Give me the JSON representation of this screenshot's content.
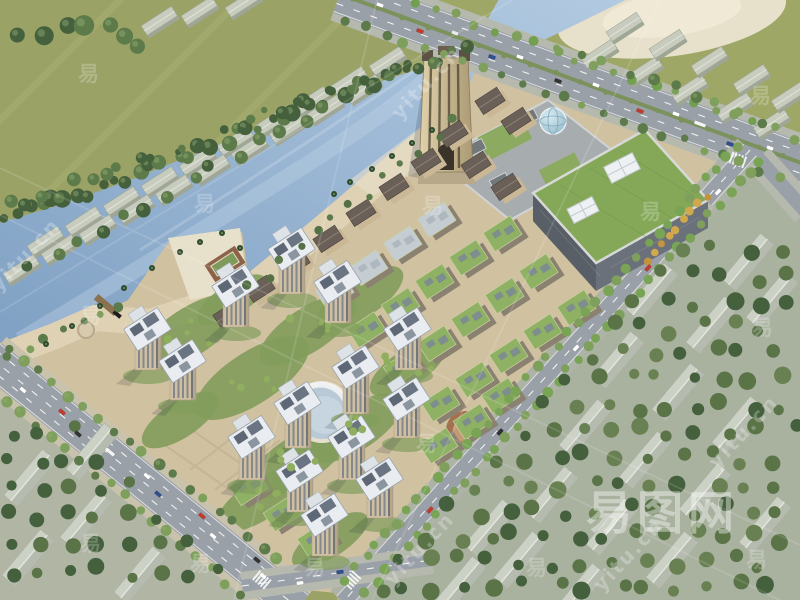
{
  "watermark": {
    "logo_text": "易图网",
    "url_text": "yitu.cn",
    "glyph_text": "易",
    "logo": {
      "x": 586,
      "y": 477,
      "size": 46,
      "letter_spacing": 5,
      "opacity": 0.4
    },
    "url_tiles": [
      {
        "x": 597,
        "y": 576
      },
      {
        "x": 388,
        "y": 570
      },
      {
        "x": 712,
        "y": 453
      },
      {
        "x": 395,
        "y": 104
      },
      {
        "x": -6,
        "y": 276
      }
    ],
    "url_size": 20,
    "url_opacity": 0.26,
    "glyphs": [
      {
        "x": 78,
        "y": 58
      },
      {
        "x": 194,
        "y": 188
      },
      {
        "x": 422,
        "y": 190
      },
      {
        "x": 640,
        "y": 196
      },
      {
        "x": 750,
        "y": 80
      },
      {
        "x": 752,
        "y": 312
      },
      {
        "x": 80,
        "y": 300
      },
      {
        "x": 416,
        "y": 428
      },
      {
        "x": 80,
        "y": 528
      },
      {
        "x": 190,
        "y": 548
      },
      {
        "x": 304,
        "y": 552
      },
      {
        "x": 526,
        "y": 552
      },
      {
        "x": 746,
        "y": 544
      }
    ],
    "glyph_size": 21,
    "glyph_opacity": 0.22
  },
  "palette": {
    "field": "#9aa266",
    "field2": "#9ea765",
    "mow": "#a9b074",
    "water1": "#7fa0c3",
    "water2": "#b3cbe2",
    "water_hl": "#c3d6e8",
    "sand": "#e7e0cb",
    "sand2": "#ddd0ae",
    "paving": "#d0c1a1",
    "paving_light": "#dfd2b4",
    "road": "#9aa0a8",
    "road_side": "#b6b9ae",
    "lane": "#ffffff",
    "median": "#7c925c",
    "tree_dark": "#44603c",
    "tree_mid": "#5d7a4a",
    "tree_light": "#7fa05c",
    "tree_pale": "#93ac74",
    "tree_yellow": "#d2a84e",
    "warehouse_roof": "#c7ccbe",
    "warehouse_side": "#9fa696",
    "house_roof": "#ccd1c5",
    "house_side": "#b2b9ac",
    "housing_ground": "#a9b19f",
    "mall_roof": "#84a858",
    "mall_wall_sw": "#585f66",
    "mall_wall_se": "#6a717a",
    "mall_trim": "#d6d9d6",
    "skylight": "#eef1f3",
    "podium": "#a7adaf",
    "courtyard": "#8cab60",
    "pavilion": "#73797b",
    "tower_hi": "#e0d2ac",
    "tower_lo": "#ab9a74",
    "tower_dark": "#544a38",
    "res_wall": "#cfc0a2",
    "res_win": "#6b7585",
    "roof_white": "#e9edf1",
    "roof_panel": "#5d6775",
    "midrise_roof": "#6a6058",
    "midrise_wall": "#c9b795",
    "shop_green": "#8fb164",
    "shop_panel": "#7b8795",
    "shop_grey": "#c5cdd2",
    "shop_wall": "#8b8170",
    "lawn": "#829c5c",
    "pool": "#b9c9d6",
    "pool_in": "#c7d5e0",
    "plaza_brown": "#a4714f",
    "plaza_ring": "#c49a76",
    "sphere1": "#d9ecf2",
    "sphere2": "#8fb6c6",
    "shadow": "#1d2430"
  }
}
